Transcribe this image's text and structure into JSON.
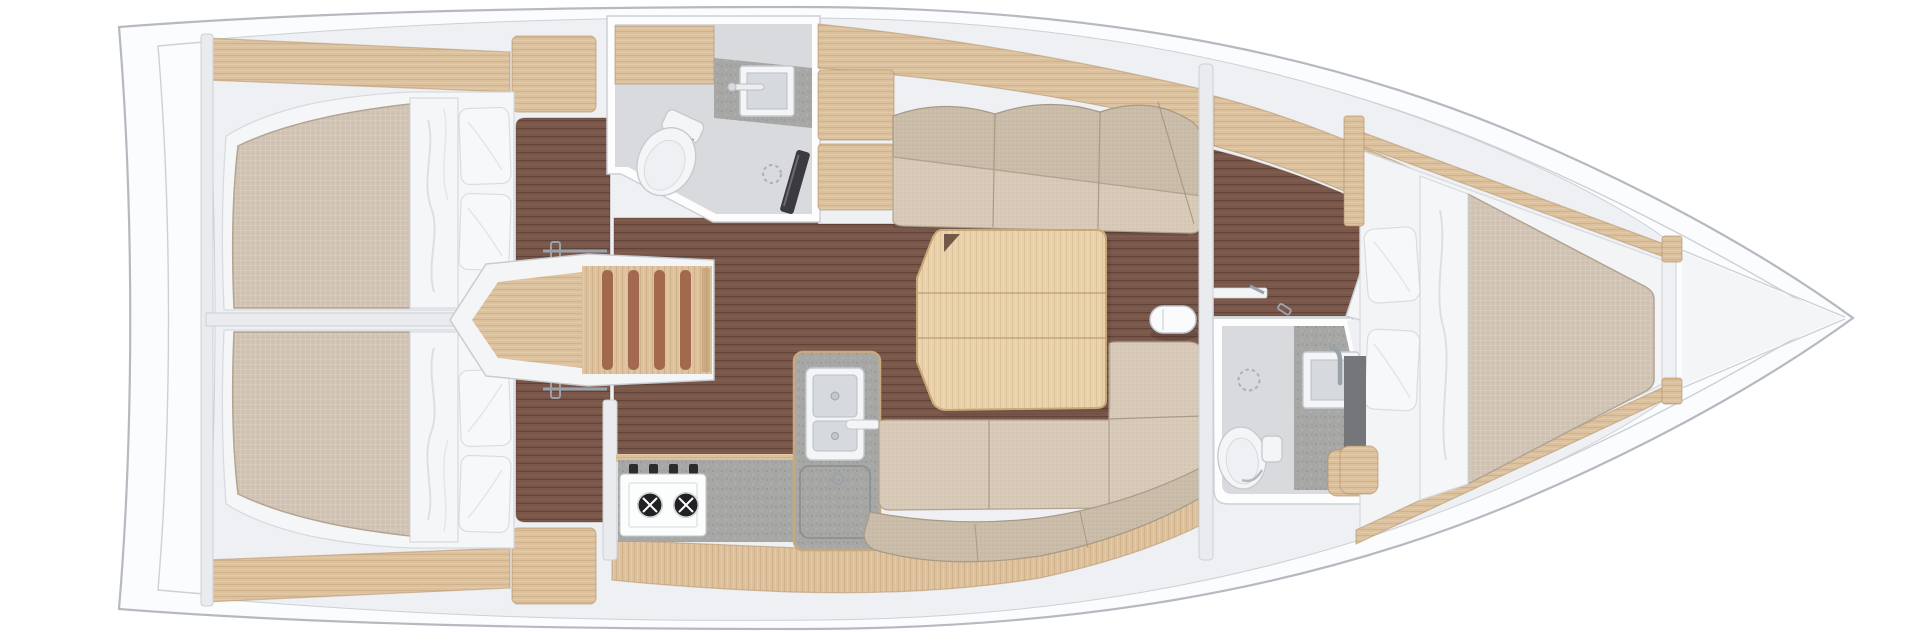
{
  "page": {
    "background": "#ffffff",
    "width": 1920,
    "height": 640
  },
  "plan": {
    "type": "sailboat-interior-floorplan",
    "view": "top-down",
    "bow_direction": "right",
    "stern_direction": "left",
    "rooms": [
      {
        "id": "aft-cabin-port",
        "fixtures": [
          "double-berth",
          "mattress",
          "bed-runner",
          "pillow",
          "pillow",
          "wardrobe",
          "hull-shelf",
          "cabin-floor",
          "door-latch"
        ]
      },
      {
        "id": "aft-cabin-starboard",
        "fixtures": [
          "double-berth",
          "mattress",
          "bed-runner",
          "pillow",
          "pillow",
          "wardrobe",
          "hull-shelf",
          "cabin-floor",
          "door-latch"
        ]
      },
      {
        "id": "companionway",
        "fixtures": [
          "landing-platform",
          "stair-treads"
        ]
      },
      {
        "id": "aft-head",
        "fixtures": [
          "toilet",
          "vanity-counter",
          "square-sink",
          "faucet",
          "shower-drain",
          "shower-panel",
          "overhead-cabinet"
        ]
      },
      {
        "id": "galley",
        "fixtures": [
          "two-burner-stove",
          "stove-knobs",
          "countertop",
          "double-sink",
          "faucet",
          "fridge-hatch",
          "cabinet-face"
        ]
      },
      {
        "id": "salon",
        "fixtures": [
          "settee-top",
          "settee-bottom",
          "corner-cushions",
          "dining-table",
          "folding-leaf",
          "mast-post",
          "wood-sole"
        ]
      },
      {
        "id": "forward-passage",
        "fixtures": [
          "door-frame",
          "door-latch",
          "door-latch",
          "locker-band"
        ]
      },
      {
        "id": "forward-head",
        "fixtures": [
          "toilet",
          "vanity-counter",
          "square-sink",
          "faucet",
          "shower-drain",
          "wood-seat",
          "angled-door"
        ]
      },
      {
        "id": "forward-cabin",
        "fixtures": [
          "v-berth",
          "mattress",
          "bed-runner",
          "pillow",
          "pillow",
          "side-shelf",
          "entry-step",
          "hull-trim"
        ]
      },
      {
        "id": "bow-locker",
        "fixtures": [
          "bulkhead-blocks",
          "anchor-locker-seams"
        ]
      }
    ]
  },
  "palette": {
    "deck": "#fbfcfd",
    "hull-stroke": "#b6bac0",
    "wall": "#eef0f3",
    "wall-line": "#ccd1d7",
    "wall-white": "#fdfdfe",
    "wood": "#dcc19c",
    "wood-dark": "#b08c5f",
    "wood-light": "#e8d1ab",
    "floor-dark": "#7b574a",
    "floor-line": "#5d4136",
    "mattress": "#cfc2b2",
    "mattress-line": "#b3a492",
    "cushion": "#cabca8",
    "cushion-light": "#d8cab7",
    "bedding": "#f5f6f8",
    "bedding-line": "#d6d9de",
    "counter": "#a7a7a5",
    "bath-floor": "#d8dadd",
    "fixture": "#f4f5f7",
    "fixture-line": "#c6cad0",
    "metal": "#9aa1a8",
    "panel-dark": "#3b3b3f",
    "tread": "#9b5f46"
  }
}
